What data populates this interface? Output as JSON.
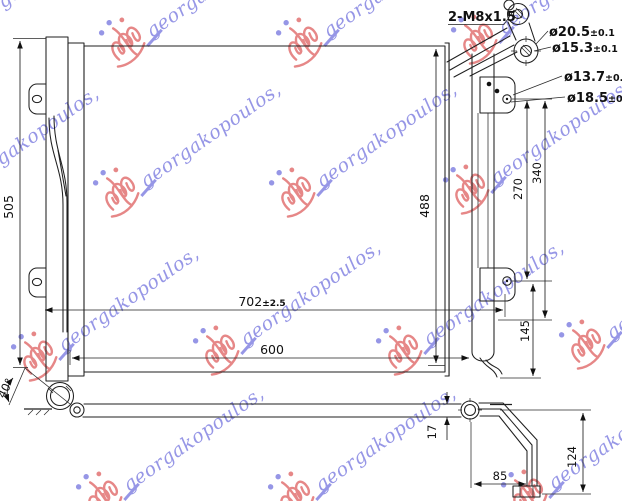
{
  "watermark": {
    "text": "georgakopoulos,",
    "text_color": "#7d7de0",
    "logo_color": "#e06a6a"
  },
  "colors": {
    "line": "#1f1f1f",
    "background": "#ffffff"
  },
  "main_view": {
    "dim_overall_height": "505",
    "dim_core_height": "488",
    "dim_overall_width": "702",
    "dim_overall_width_tol": "±2.5",
    "dim_core_width": "600",
    "dim_mount_span_outer": "340",
    "dim_mount_span_inner": "270",
    "dim_mount_to_bottom": "145",
    "callout_thread": "2-M8x1.5",
    "callout_port_outer_dia": "ø20.5",
    "callout_port_outer_tol": "±0.1",
    "callout_port_inner_dia": "ø15.3",
    "callout_port_inner_tol": "±0.1",
    "callout_stud_hole_dia": "ø13.7",
    "callout_stud_hole_tol": "±0.1",
    "callout_bracket_hole_dia": "ø18.5",
    "callout_bracket_hole_tol": "±0.1"
  },
  "bottom_view": {
    "dim_pipe_angle": "40°",
    "dim_thickness": "17",
    "dim_foot_offset": "85",
    "dim_bracket_drop": "124"
  }
}
